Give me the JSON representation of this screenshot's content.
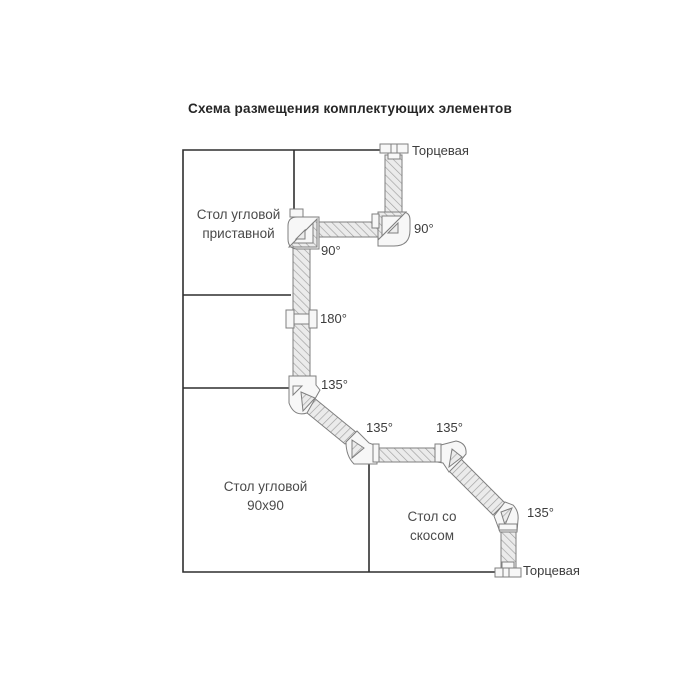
{
  "title": "Схема размещения комплектующих элементов",
  "areas": {
    "corner_attached": {
      "line1": "Стол угловой",
      "line2": "приставной"
    },
    "corner_90": {
      "line1": "Стол угловой",
      "line2": "90х90"
    },
    "bevel": {
      "line1": "Стол со",
      "line2": "скосом"
    }
  },
  "callouts": {
    "end_piece_top": "Торцевая",
    "end_piece_bottom": "Торцевая",
    "angle_90_right": "90°",
    "angle_90_left": "90°",
    "angle_180": "180°",
    "angle_135_1": "135°",
    "angle_135_2": "135°",
    "angle_135_3": "135°",
    "angle_135_4": "135°"
  },
  "colors": {
    "outline": "#2f2f2f",
    "profile_stroke": "#7f7f7f",
    "profile_fill": "#ebebeb",
    "hatch_line": "#9e9e9e",
    "connector_fill": "#f7f7f7",
    "text": "#3d3d3d"
  }
}
